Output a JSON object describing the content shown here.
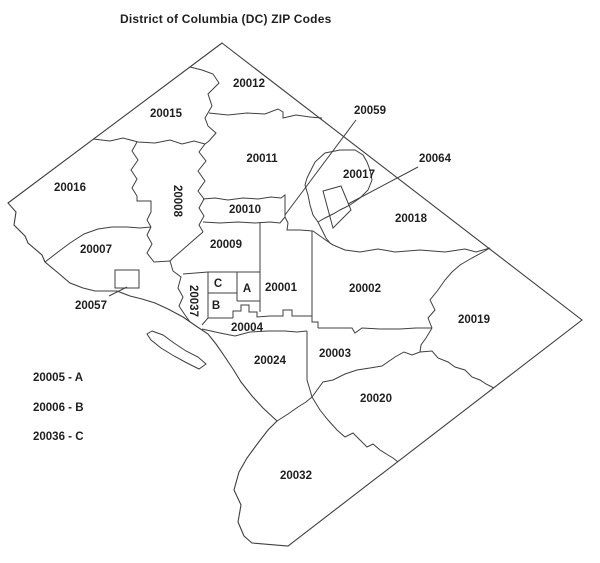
{
  "title": "District of Columbia (DC) ZIP Codes",
  "legend": {
    "items": [
      {
        "label": "20005 - A"
      },
      {
        "label": "20006 - B"
      },
      {
        "label": "20036 - C"
      }
    ]
  },
  "map": {
    "background": "#ffffff",
    "line_color": "#3f3f3f",
    "text_color": "#1f1f1f",
    "outline": "M222,43 L582,320 L288,546 L252,543 L244,536 L238,522 L241,505 L234,490 L239,472 L247,458 L258,443 L268,430 L277,421 L263,408 L252,396 L241,382 L233,369 L225,357 L216,344 L208,334 L196,326 L183,317 L168,309 L155,303 L142,299 L130,296 L117,291 L105,291 L95,291 L83,288 L70,283 L57,272 L45,262 L42,255 L28,243 L25,236 L14,225 L16,212 L8,203 Z",
    "island": "M152,331 L163,335 L174,343 L186,351 L198,357 L206,364 L199,369 L187,363 L174,356 L161,348 L151,340 L147,334 Z",
    "boundaries": [
      "M93,139 L110,141 L123,138 L138,142 L155,143 L170,140 L182,144 L194,141 L205,144",
      "M190,67 L202,70 L213,74 L219,83 L208,94 L212,106 L205,118 L208,126 L216,133 L209,141 L205,144 L199,152 L206,161 L198,171 L205,181 L198,191 L204,199 L199,208 L204,216 L199,225 L203,232",
      "M209,113 L228,115 L247,113 L265,114 L278,109 L283,112 L283,118 L296,115 L310,117 L322,118",
      "M137,142 L132,151 L138,160 L131,170 L137,179 L132,188 L137,196 L137,201 L151,201 L151,212 L147,220 L151,227",
      "M45,262 L58,252 L70,243 L84,234 L98,229 L112,227 L127,227 L140,228 L151,227",
      "M151,227 L147,235 L152,244 L147,253 L154,262 L170,261 L173,271 L181,277 L178,288 L183,297 L179,306 L185,315 L190,322",
      "M203,199 L215,198 L228,200 L243,198 L258,199 L271,197 L281,198 L285,195 L285,217",
      "M203,222 L220,223 L238,222 L255,223 L270,222 L280,223 L285,217",
      "M203,232 L196,238 L188,245 L180,252 L173,258 L170,261",
      "M183,274 L208,272 L237,272 L260,272",
      "M208,272 L208,318 L202,325",
      "M237,272 L237,301",
      "M208,293 L237,293",
      "M208,318 L233,318",
      "M260,222 L260,312",
      "M237,301 L260,301",
      "M233,318 L233,311 L241,311 L241,305 L249,305 L249,312 L257,312 L257,317 L270,316 L283,316 L283,310 L292,310 L292,316 L312,316",
      "M312,231 L312,316 L312,322 L318,322 L318,328",
      "M285,217 L288,223 L287,230 L300,230 L313,231",
      "M313,231 L320,236 L327,241 L333,245",
      "M310,172 L315,162 L325,153 L340,150 L355,150 L363,155 L367,162 L370,170 L372,180 L368,190 L360,198 L350,205 L340,210 L333,214 L325,218 L318,222 L313,215 L310,205 L308,195 L305,185 L307,178 Z",
      "M323,191 L341,186 L351,210 L333,228 Z",
      "M318,222 L322,230 L326,238 L330,243 L333,245",
      "M333,245 L345,250 L360,252 L378,249 L395,252 L420,250 L445,252 L465,249 L476,252 L483,250 L490,248",
      "M490,248 L483,252 L472,258 L460,265 L452,272 L445,280 L438,290 L430,300 L435,310 L428,318 L432,328",
      "M318,328 L340,328 L352,328 L355,333 L362,328 L380,329 L400,329 L416,328 L432,328",
      "M432,328 L426,338 L421,345 L420,352",
      "M307,331 L307,380 L310,390 L312,397",
      "M202,329 L220,333 L235,336 L250,332 L268,331 L285,331 L297,332 L307,331",
      "M277,421 L288,414 L298,407 L306,402 L312,397",
      "M312,397 L323,382 L333,380 L345,374 L357,370 L370,368 L382,366 L395,357 L404,352 L412,355 L420,352",
      "M420,352 L432,351 L438,358 L448,362 L455,367 L465,370 L472,377 L480,380 L486,384 L494,388",
      "M312,397 L320,410 L328,420 L337,430 L345,437 L353,433 L360,440 L367,447 L373,444 L380,450 L388,455 L393,458 L398,462",
      "M115,270 L139,270 L139,288 L115,288 Z"
    ],
    "leader_lines": [
      {
        "zip": "20059",
        "x1": 356,
        "y1": 120,
        "x2": 285,
        "y2": 215
      },
      {
        "zip": "20064",
        "x1": 418,
        "y1": 167,
        "x2": 348,
        "y2": 204
      },
      {
        "zip": "20057",
        "x1": 109,
        "y1": 296,
        "x2": 127,
        "y2": 287
      }
    ],
    "labels": [
      {
        "text": "20012",
        "x": 249,
        "y": 87,
        "rotate": 0
      },
      {
        "text": "20015",
        "x": 166,
        "y": 117,
        "rotate": 0
      },
      {
        "text": "20059",
        "x": 370,
        "y": 114,
        "rotate": 0
      },
      {
        "text": "20011",
        "x": 262,
        "y": 162,
        "rotate": 0
      },
      {
        "text": "20017",
        "x": 359,
        "y": 178,
        "rotate": 0
      },
      {
        "text": "20064",
        "x": 435,
        "y": 162,
        "rotate": 0
      },
      {
        "text": "20016",
        "x": 70,
        "y": 191,
        "rotate": 0
      },
      {
        "text": "20008",
        "x": 174,
        "y": 201,
        "rotate": 90
      },
      {
        "text": "20010",
        "x": 245,
        "y": 213,
        "rotate": 0
      },
      {
        "text": "20018",
        "x": 411,
        "y": 222,
        "rotate": 0
      },
      {
        "text": "20007",
        "x": 96,
        "y": 253,
        "rotate": 0
      },
      {
        "text": "20009",
        "x": 226,
        "y": 248,
        "rotate": 0
      },
      {
        "text": "20001",
        "x": 281,
        "y": 291,
        "rotate": 0
      },
      {
        "text": "20002",
        "x": 365,
        "y": 292,
        "rotate": 0
      },
      {
        "text": "20057",
        "x": 91,
        "y": 309,
        "rotate": 0
      },
      {
        "text": "20037",
        "x": 190,
        "y": 301,
        "rotate": 90
      },
      {
        "text": "20019",
        "x": 474,
        "y": 323,
        "rotate": 0
      },
      {
        "text": "20004",
        "x": 247,
        "y": 331,
        "rotate": 0
      },
      {
        "text": "20024",
        "x": 270,
        "y": 364,
        "rotate": 0
      },
      {
        "text": "20003",
        "x": 335,
        "y": 357,
        "rotate": 0
      },
      {
        "text": "20020",
        "x": 376,
        "y": 402,
        "rotate": 0
      },
      {
        "text": "20032",
        "x": 296,
        "y": 479,
        "rotate": 0
      },
      {
        "text": "A",
        "x": 247,
        "y": 292,
        "rotate": 0
      },
      {
        "text": "B",
        "x": 216,
        "y": 309,
        "rotate": 0
      },
      {
        "text": "C",
        "x": 218,
        "y": 287,
        "rotate": 0
      }
    ]
  }
}
